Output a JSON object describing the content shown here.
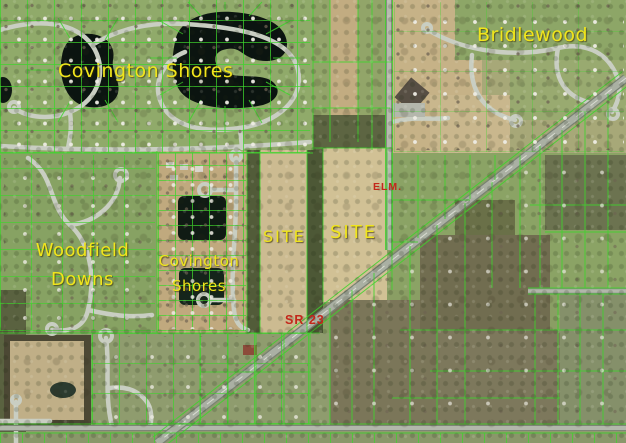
{
  "map": {
    "kind": "aerial-parcel-map",
    "labels": {
      "covington_shores_north": "Covington Shores",
      "bridlewood": "Bridlewood",
      "woodfield_downs": {
        "line1": "Woodfield",
        "line2": "Downs"
      },
      "covington_shores_south": {
        "line1": "Covington",
        "line2": "Shores"
      },
      "site_west": "SITE",
      "site_east": "SITE",
      "elm_road": "ELM.",
      "sr_23": "SR 23"
    },
    "colors": {
      "subdivision_label": "#f0e51c",
      "road_label": "#c3281b",
      "parcel_line": "#3ed42c",
      "water": "#0b1410",
      "field_tan": "#ccbb91",
      "lawn_green": "#8a9e64",
      "road_gray": "#aab0a3"
    }
  }
}
